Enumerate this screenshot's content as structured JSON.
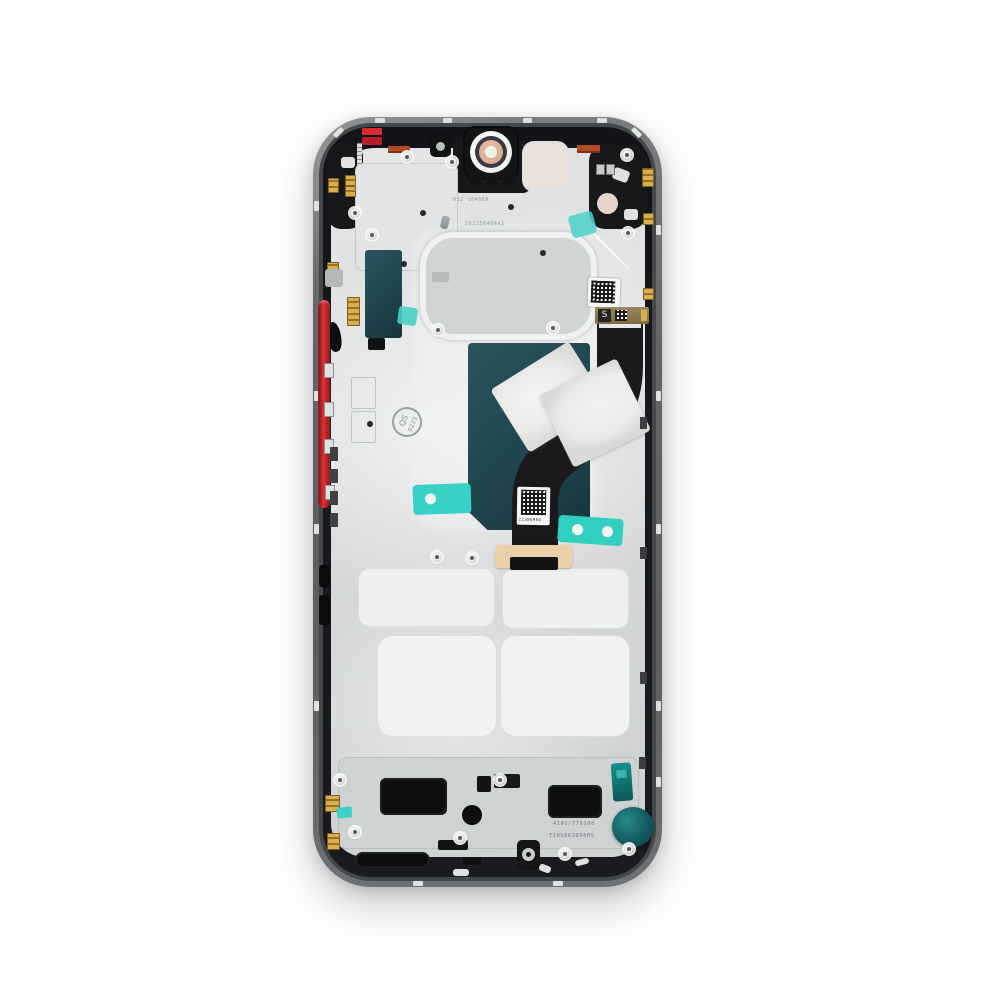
{
  "image_type": "product-photo",
  "subject": "Smartphone internal mid-frame chassis (inside view) centered on a white background",
  "colors": {
    "bg": "#ffffff",
    "frame_outer": "#6b6e70",
    "frame_dark": "#17181a",
    "plate_silver": "#d7d9da",
    "shield_teal": "#20454c",
    "flex_black": "#19191b",
    "tape_cyan": "#38d1c5",
    "button_red": "#d62a31",
    "contact_gold": "#d8ae4e",
    "foil_white": "#ebecea",
    "pad_white": "#eff0f0",
    "motor_teal": "#135a60",
    "camera_ring_peach": "#d9ae92",
    "sticker_pink": "#e7d4ca",
    "label_orange": "#b34a26",
    "qr_dark": "#1c1c1e"
  },
  "labels": {
    "flex_connector_marking": "S",
    "qs_stamp_line1": "QS",
    "qs_stamp_line2": "0223",
    "flex_qr_code": "IZ3W8904",
    "plate_stamp_line1": "N12 1049ER",
    "plate_stamp_line2": "3022504B4A2",
    "bottom_code_line1": "4101/770108",
    "bottom_code_line2": "TJHS8K2DX6HS"
  }
}
